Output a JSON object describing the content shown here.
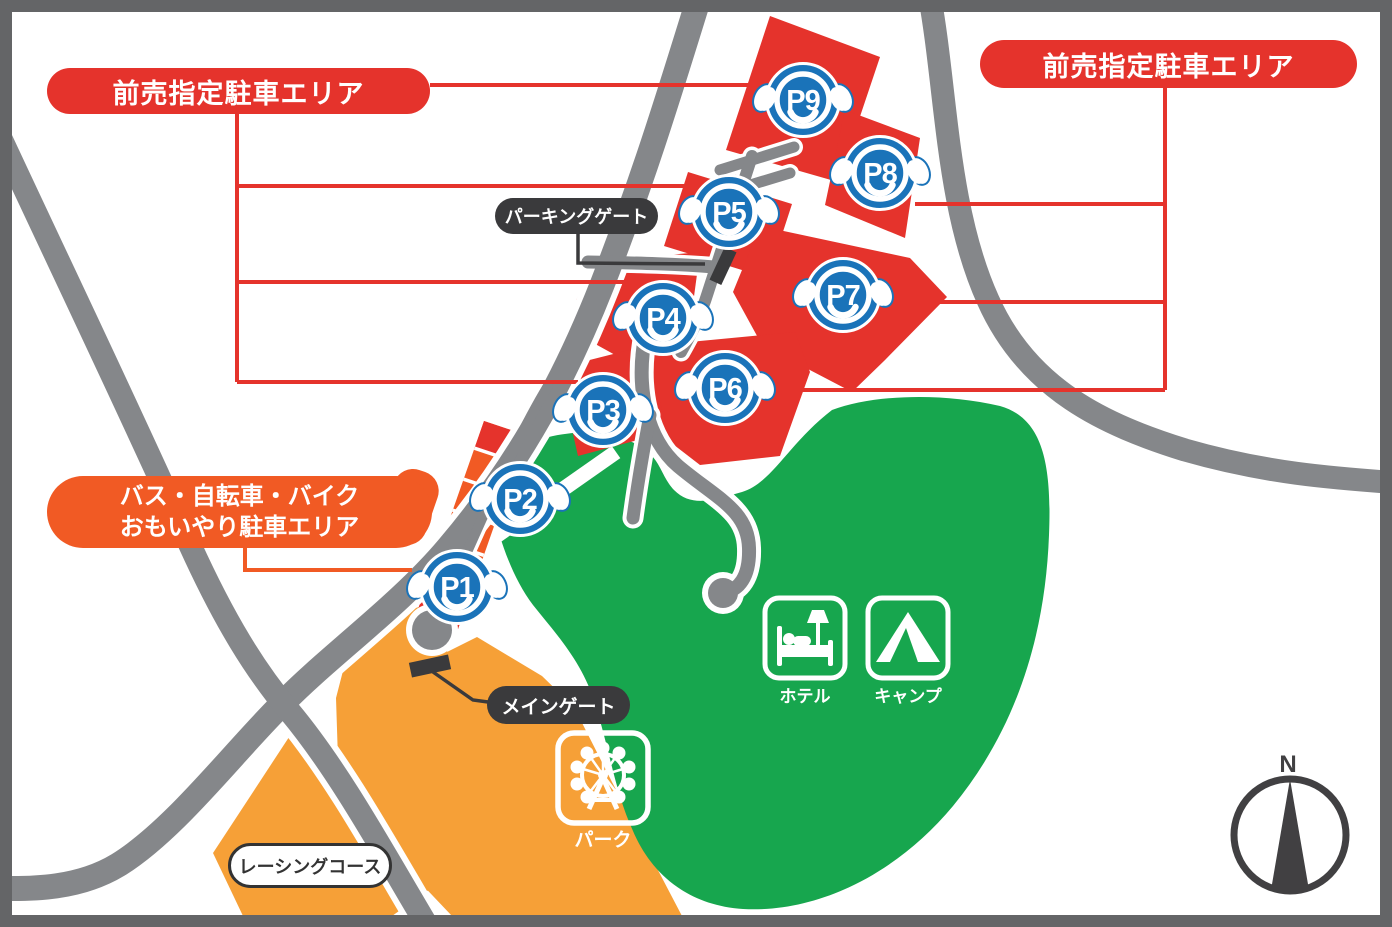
{
  "labels": {
    "advance": "前売指定駐車エリア",
    "bus_line1": "バス・自転車・バイク",
    "bus_line2": "おもいやり駐車エリア",
    "parking_gate": "パーキングゲート",
    "main_gate": "メインゲート",
    "racing_course": "レーシングコース",
    "hotel": "ホテル",
    "camp": "キャンプ",
    "park": "パーク",
    "north": "N"
  },
  "spots": [
    {
      "id": "P1"
    },
    {
      "id": "P2"
    },
    {
      "id": "P3"
    },
    {
      "id": "P4"
    },
    {
      "id": "P5"
    },
    {
      "id": "P6"
    },
    {
      "id": "P7"
    },
    {
      "id": "P8"
    },
    {
      "id": "P9"
    }
  ],
  "colors": {
    "reserved_red": "#e5332c",
    "bus_orange": "#f15a24",
    "park_amber": "#f6a037",
    "hotel_green": "#17a64e",
    "parking_blue": "#1a73b9",
    "road_gray": "#85878a",
    "border_gray": "#646567",
    "gate_black": "#3a3a3c"
  }
}
